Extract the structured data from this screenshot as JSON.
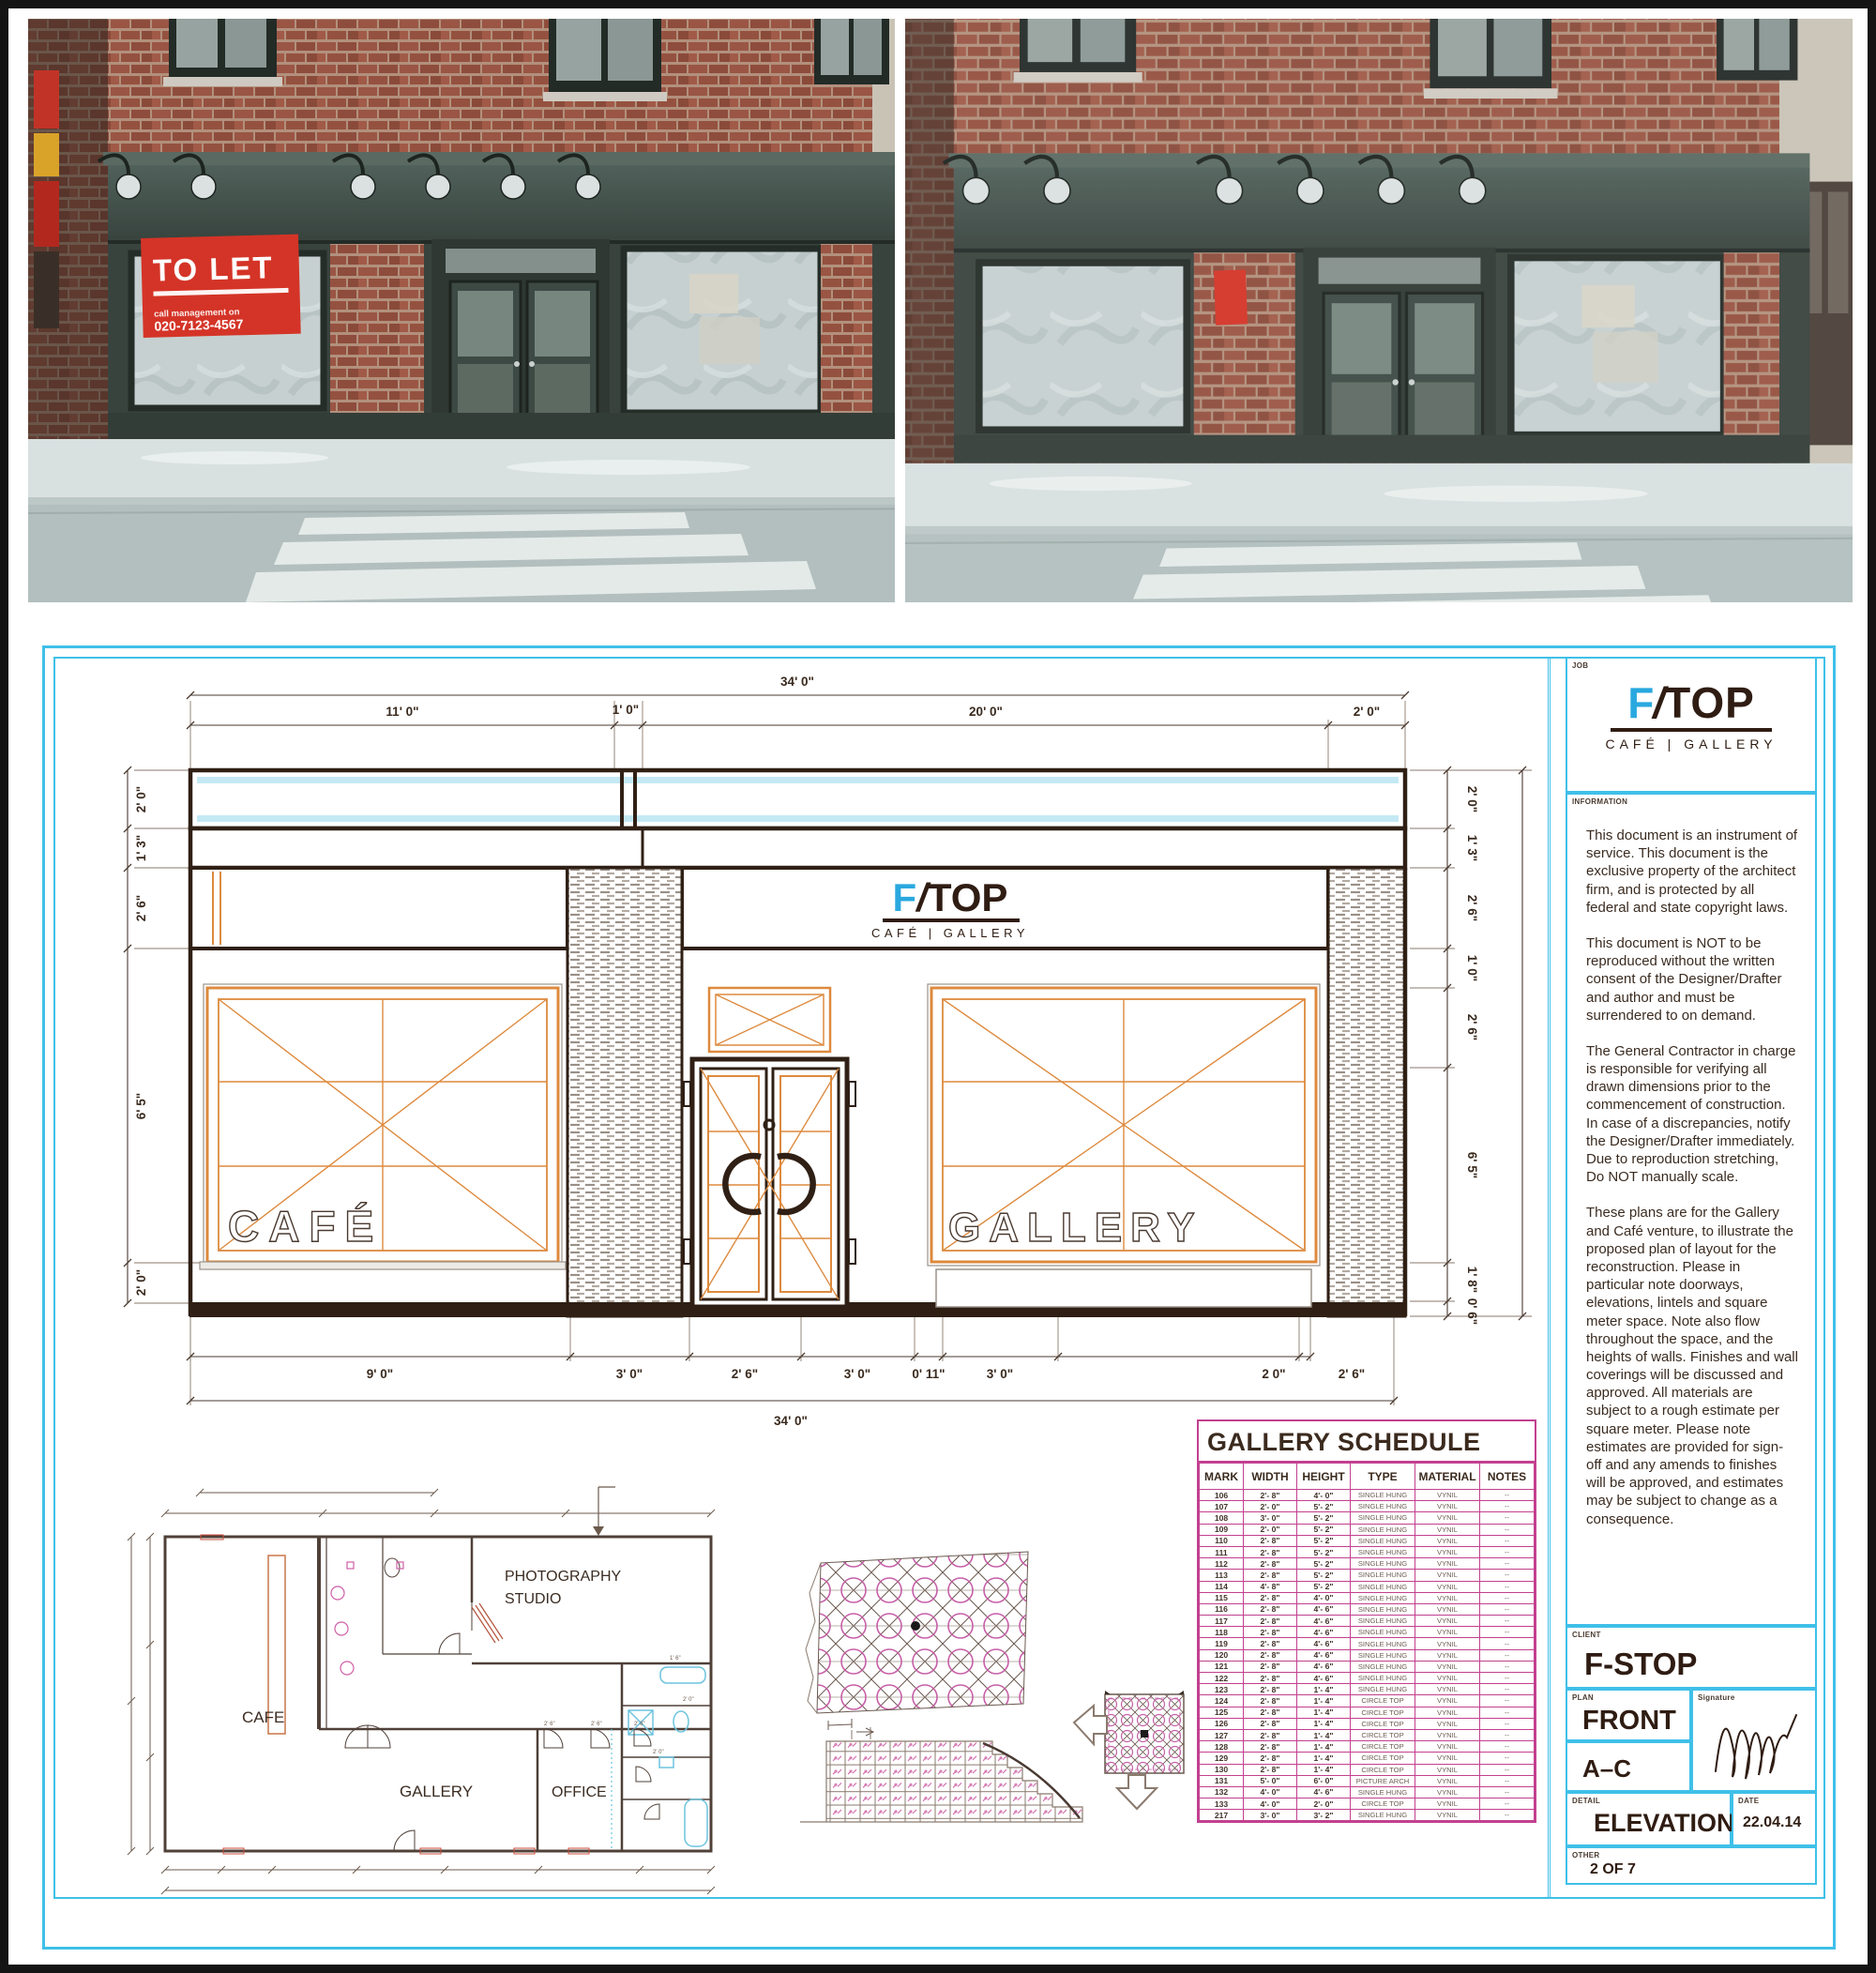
{
  "brand": {
    "wordmark_f": "F",
    "wordmark_slash": "/",
    "wordmark_rest": "TOP",
    "tagline": "CAFÉ | GALLERY"
  },
  "photos": {
    "to_let_sign": {
      "line1": "TO LET",
      "line2": "call management on",
      "line3": "020-7123-4567"
    }
  },
  "elevation": {
    "window_labels": {
      "left": "CAFÉ",
      "right": "GALLERY"
    },
    "dims": {
      "top_overall": "34' 0\"",
      "top_segments": [
        "11' 0\"",
        "1' 0\"",
        "20' 0\"",
        "2' 0\""
      ],
      "bottom_segments": [
        "9' 0\"",
        "3' 0\"",
        "2' 6\"",
        "3' 0\"",
        "0' 11\"",
        "3' 0\"",
        "2 0\"",
        "2' 6\""
      ],
      "bottom_overall": "34' 0\"",
      "left_segments": [
        "2' 0\"",
        "1' 3\"",
        "2' 6\"",
        "6' 5\"",
        "2' 0\""
      ],
      "right_segments": [
        "2' 0\"",
        "1' 3\"",
        "2' 6\"",
        "1' 0\"",
        "2' 6\"",
        "6' 5\"",
        "1' 8\"",
        "0' 6\""
      ],
      "right_overall": "24' 0\""
    }
  },
  "floor_plan": {
    "room_cafe": "CAFE",
    "room_gallery": "GALLERY",
    "room_studio_line1": "PHOTOGRAPHY",
    "room_studio_line2": "STUDIO",
    "room_office": "OFFICE",
    "door_dims": [
      "2' 6\"",
      "2' 6\"",
      "2' 6\"",
      "2' 0\"",
      "2' 0\"",
      "1' 6\""
    ]
  },
  "schedule": {
    "title": "GALLERY SCHEDULE",
    "headers": [
      "MARK",
      "WIDTH",
      "HEIGHT",
      "TYPE",
      "MATERIAL",
      "NOTES"
    ],
    "rows": [
      {
        "mark": "106",
        "width": "2'- 8\"",
        "height": "4'- 0\"",
        "type": "SINGLE HUNG",
        "material": "VYNIL",
        "notes": "--"
      },
      {
        "mark": "107",
        "width": "2'- 0\"",
        "height": "5'- 2\"",
        "type": "SINGLE HUNG",
        "material": "VYNIL",
        "notes": "--"
      },
      {
        "mark": "108",
        "width": "3'- 0\"",
        "height": "5'- 2\"",
        "type": "SINGLE HUNG",
        "material": "VYNIL",
        "notes": "--"
      },
      {
        "mark": "109",
        "width": "2'- 0\"",
        "height": "5'- 2\"",
        "type": "SINGLE HUNG",
        "material": "VYNIL",
        "notes": "--"
      },
      {
        "mark": "110",
        "width": "2'- 8\"",
        "height": "5'- 2\"",
        "type": "SINGLE HUNG",
        "material": "VYNIL",
        "notes": "--"
      },
      {
        "mark": "111",
        "width": "2'- 8\"",
        "height": "5'- 2\"",
        "type": "SINGLE HUNG",
        "material": "VYNIL",
        "notes": "--"
      },
      {
        "mark": "112",
        "width": "2'- 8\"",
        "height": "5'- 2\"",
        "type": "SINGLE HUNG",
        "material": "VYNIL",
        "notes": "--"
      },
      {
        "mark": "113",
        "width": "2'- 8\"",
        "height": "5'- 2\"",
        "type": "SINGLE HUNG",
        "material": "VYNIL",
        "notes": "--"
      },
      {
        "mark": "114",
        "width": "4'- 8\"",
        "height": "5'- 2\"",
        "type": "SINGLE HUNG",
        "material": "VYNIL",
        "notes": "--"
      },
      {
        "mark": "115",
        "width": "2'- 8\"",
        "height": "4'- 0\"",
        "type": "SINGLE HUNG",
        "material": "VYNIL",
        "notes": "--"
      },
      {
        "mark": "116",
        "width": "2'- 8\"",
        "height": "4'- 6\"",
        "type": "SINGLE HUNG",
        "material": "VYNIL",
        "notes": "--"
      },
      {
        "mark": "117",
        "width": "2'- 8\"",
        "height": "4'- 6\"",
        "type": "SINGLE HUNG",
        "material": "VYNIL",
        "notes": "--"
      },
      {
        "mark": "118",
        "width": "2'- 8\"",
        "height": "4'- 6\"",
        "type": "SINGLE HUNG",
        "material": "VYNIL",
        "notes": "--"
      },
      {
        "mark": "119",
        "width": "2'- 8\"",
        "height": "4'- 6\"",
        "type": "SINGLE HUNG",
        "material": "VYNIL",
        "notes": "--"
      },
      {
        "mark": "120",
        "width": "2'- 8\"",
        "height": "4'- 6\"",
        "type": "SINGLE HUNG",
        "material": "VYNIL",
        "notes": "--"
      },
      {
        "mark": "121",
        "width": "2'- 8\"",
        "height": "4'- 6\"",
        "type": "SINGLE HUNG",
        "material": "VYNIL",
        "notes": "--"
      },
      {
        "mark": "122",
        "width": "2'- 8\"",
        "height": "4'- 6\"",
        "type": "SINGLE HUNG",
        "material": "VYNIL",
        "notes": "--"
      },
      {
        "mark": "123",
        "width": "2'- 8\"",
        "height": "1'- 4\"",
        "type": "SINGLE HUNG",
        "material": "VYNIL",
        "notes": "--"
      },
      {
        "mark": "124",
        "width": "2'- 8\"",
        "height": "1'- 4\"",
        "type": "CIRCLE TOP",
        "material": "VYNIL",
        "notes": "--"
      },
      {
        "mark": "125",
        "width": "2'- 8\"",
        "height": "1'- 4\"",
        "type": "CIRCLE TOP",
        "material": "VYNIL",
        "notes": "--"
      },
      {
        "mark": "126",
        "width": "2'- 8\"",
        "height": "1'- 4\"",
        "type": "CIRCLE TOP",
        "material": "VYNIL",
        "notes": "--"
      },
      {
        "mark": "127",
        "width": "2'- 8\"",
        "height": "1'- 4\"",
        "type": "CIRCLE TOP",
        "material": "VYNIL",
        "notes": "--"
      },
      {
        "mark": "128",
        "width": "2'- 8\"",
        "height": "1'- 4\"",
        "type": "CIRCLE TOP",
        "material": "VYNIL",
        "notes": "--"
      },
      {
        "mark": "129",
        "width": "2'- 8\"",
        "height": "1'- 4\"",
        "type": "CIRCLE TOP",
        "material": "VYNIL",
        "notes": "--"
      },
      {
        "mark": "130",
        "width": "2'- 8\"",
        "height": "1'- 4\"",
        "type": "CIRCLE TOP",
        "material": "VYNIL",
        "notes": "--"
      },
      {
        "mark": "131",
        "width": "5'- 0\"",
        "height": "6'- 0\"",
        "type": "PICTURE ARCH",
        "material": "VYNIL",
        "notes": "--"
      },
      {
        "mark": "132",
        "width": "4'- 0\"",
        "height": "4'- 6\"",
        "type": "SINGLE HUNG",
        "material": "VYNIL",
        "notes": "--"
      },
      {
        "mark": "133",
        "width": "4'- 0\"",
        "height": "2'- 0\"",
        "type": "CIRCLE TOP",
        "material": "VYNIL",
        "notes": "--"
      },
      {
        "mark": "217",
        "width": "3'- 0\"",
        "height": "3'- 2\"",
        "type": "SINGLE HUNG",
        "material": "VYNIL",
        "notes": "--"
      }
    ]
  },
  "titleblock": {
    "job_label": "JOB",
    "information_label": "INFORMATION",
    "info_paragraphs": [
      "This document is an instrument of service. This document is the exclusive property of the architect firm, and is protected by all federal and state copyright laws.",
      "This document is NOT to be reproduced without the written consent of the Designer/Drafter and author and must be surrendered to on demand.",
      "The General Contractor in charge is responsible for verifying all drawn dimensions prior to the commencement of construction. In case of a discrepancies, notify the Designer/Drafter immediately. Due to reproduction stretching, Do NOT manually scale.",
      "These plans are for the Gallery and Café venture, to illustrate the proposed plan of layout for the reconstruction. Please in particular note doorways, elevations, lintels and square meter space. Note also flow throughout the space, and the heights of walls. Finishes and wall coverings will be discussed and approved. All materials are subject to a rough estimate per square meter. Please note estimates are provided for sign-off and any amends to finishes will be approved, and estimates may be subject to change as a consequence."
    ],
    "client_label": "CLIENT",
    "client": "F-STOP",
    "plan_label": "PLAN",
    "plan": "FRONT",
    "plan_range": "A–C",
    "signature_label": "Signature",
    "detail_label": "DETAIL",
    "detail": "ELEVATION",
    "date_label": "DATE",
    "date": "22.04.14",
    "other_label": "OTHER",
    "other": "2 OF 7"
  }
}
